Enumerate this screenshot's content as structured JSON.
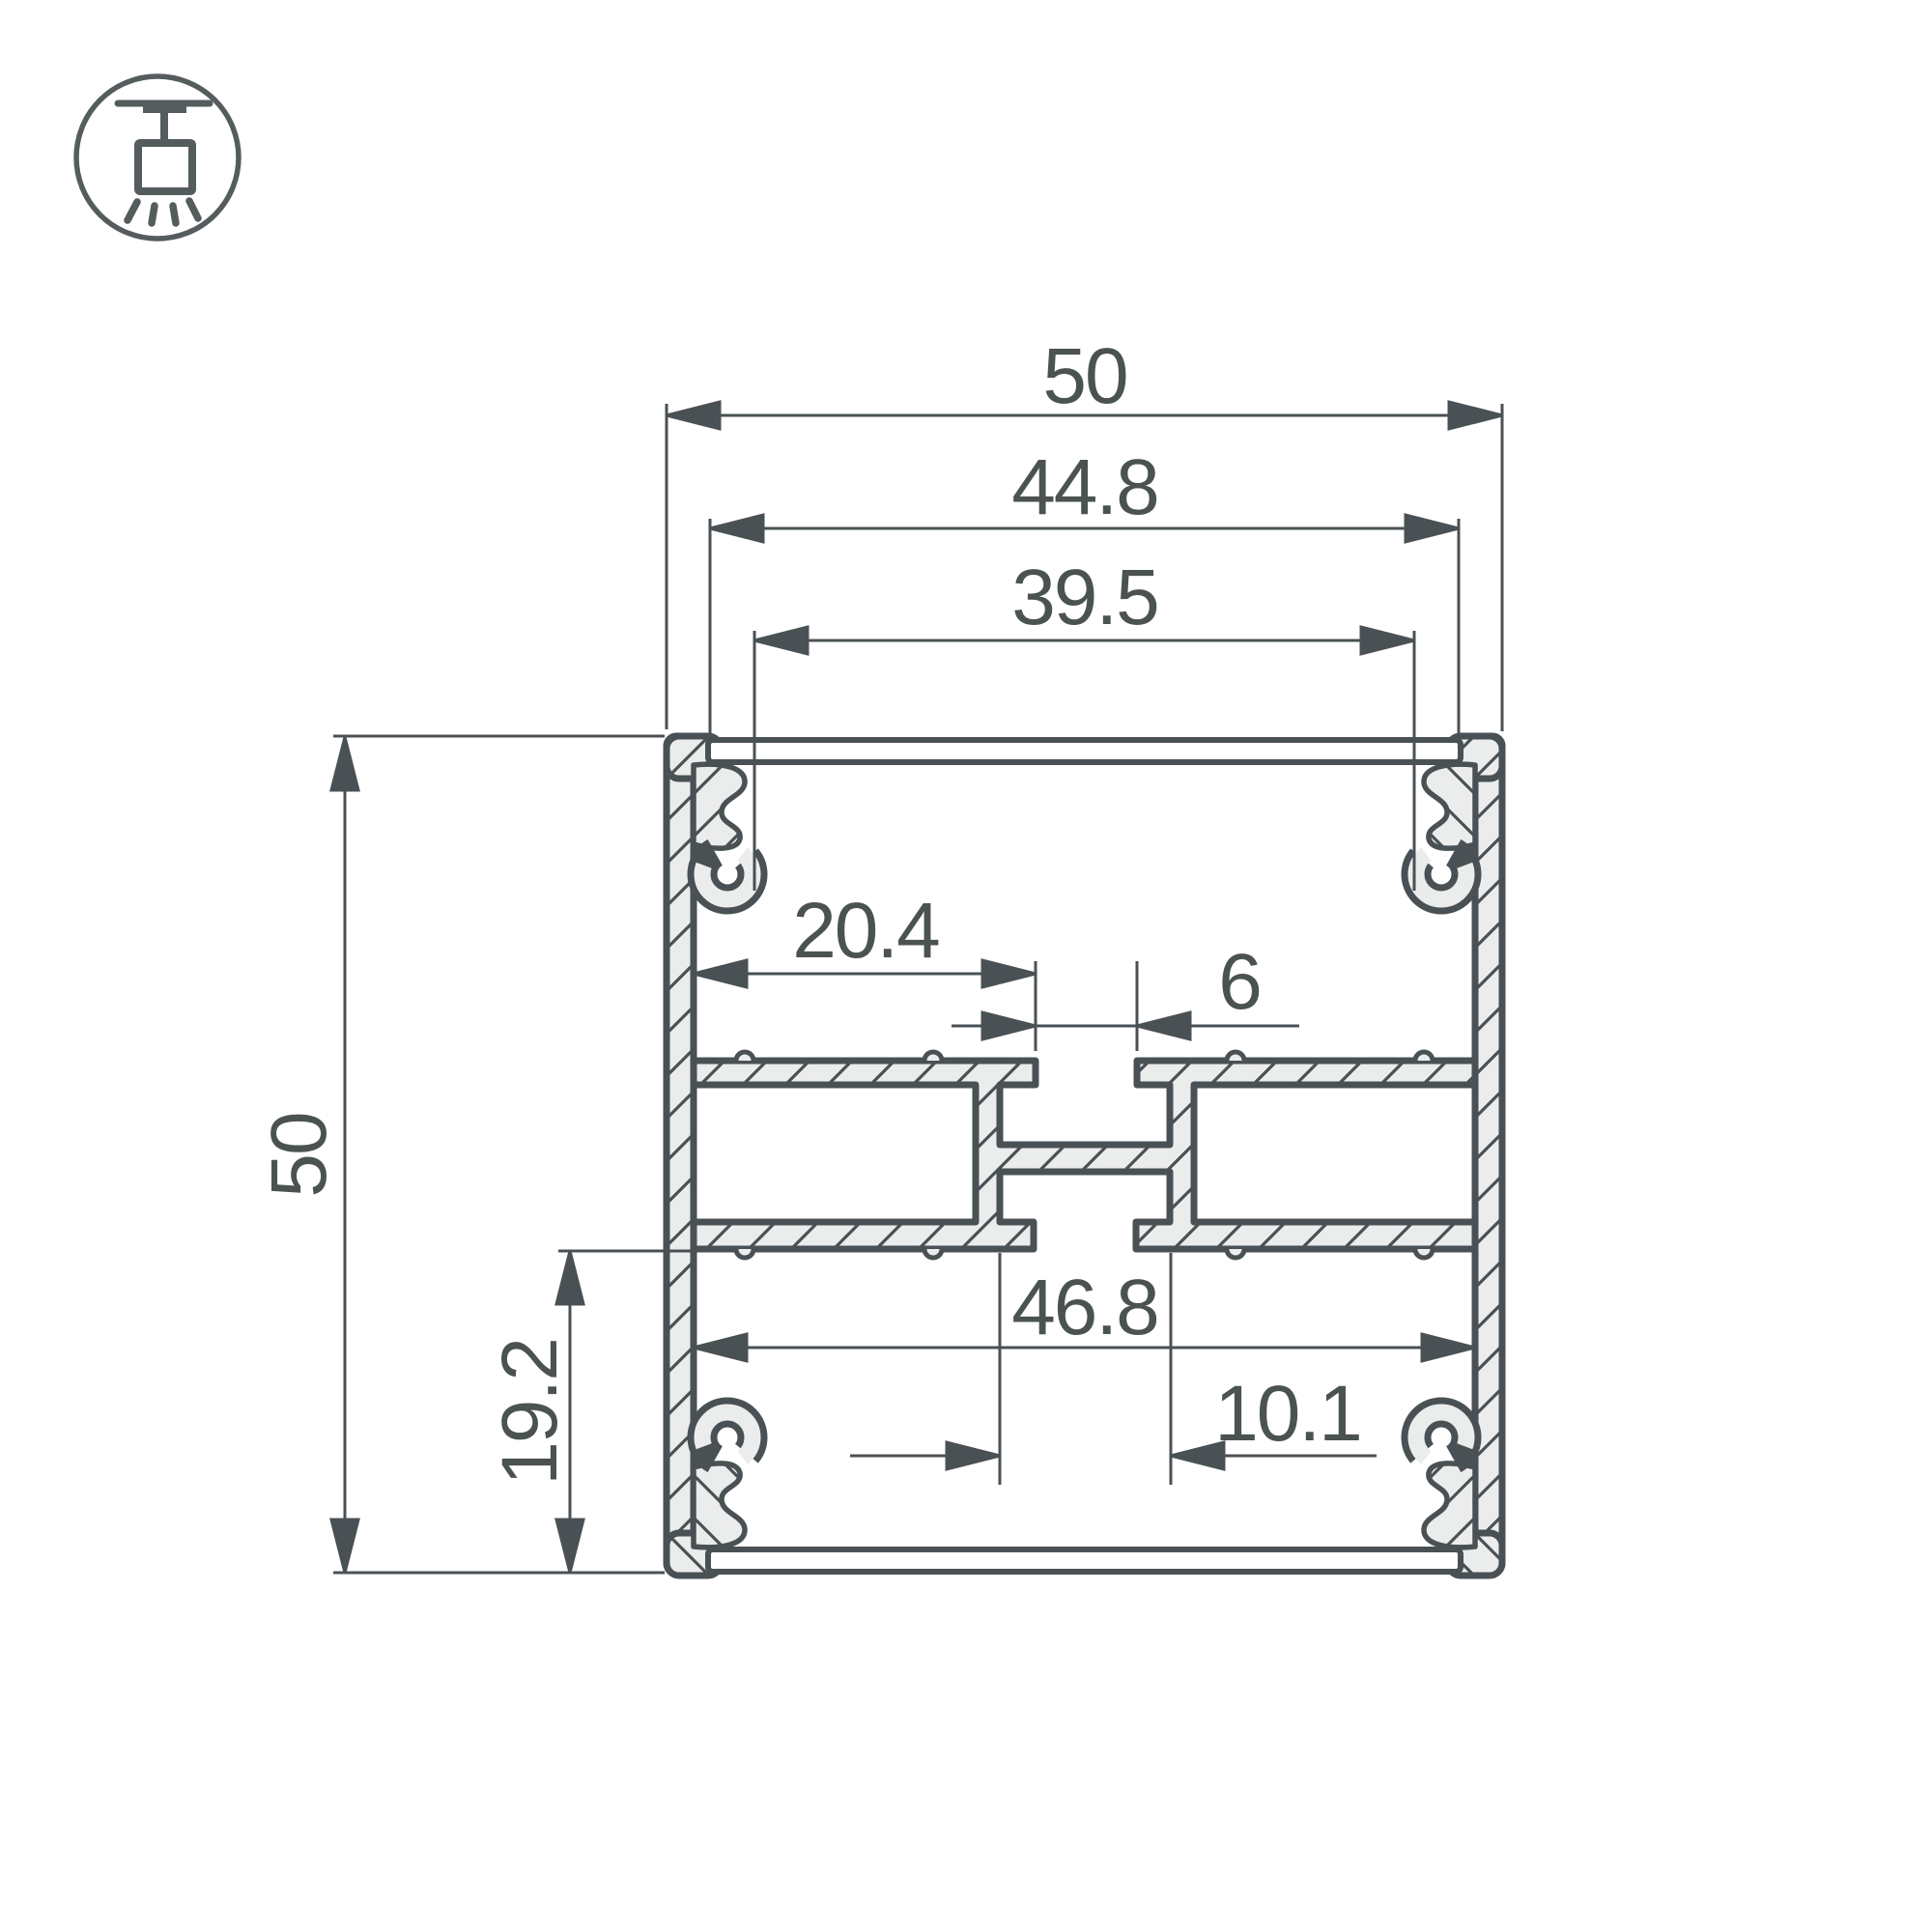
{
  "title": "LED profile cross-section drawing 50x50",
  "icon": {
    "name": "suspended-luminaire-icon",
    "meaning": "suspended (pendant) mounting"
  },
  "colors": {
    "background": "#ffffff",
    "outline": "#4a5154",
    "metal_fill": "#ebecec",
    "text": "#4b5351"
  },
  "dimensions": {
    "outer_width": {
      "label": "50"
    },
    "cover_width": {
      "label": "44.8"
    },
    "clip_opening_width": {
      "label": "39.5"
    },
    "shelf_width": {
      "label": "20.4"
    },
    "top_slot_width": {
      "label": "6"
    },
    "inner_width": {
      "label": "46.8"
    },
    "bottom_slot_width": {
      "label": "10.1"
    },
    "bottom_channel_depth": {
      "label": "19.2"
    },
    "outer_height": {
      "label": "50"
    }
  }
}
